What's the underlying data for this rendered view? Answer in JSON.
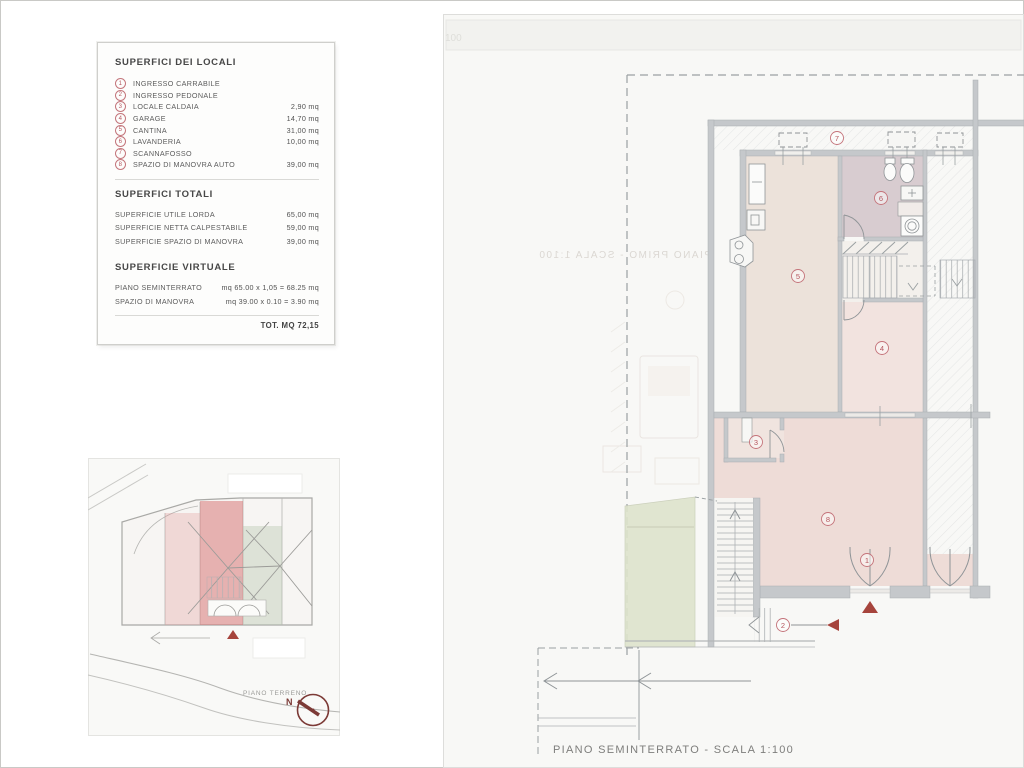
{
  "legend": {
    "title": "SUPERFICI DEI LOCALI",
    "items": [
      {
        "num": "1",
        "label": "INGRESSO CARRABILE",
        "value": ""
      },
      {
        "num": "2",
        "label": "INGRESSO PEDONALE",
        "value": ""
      },
      {
        "num": "3",
        "label": "LOCALE CALDAIA",
        "value": "2,90 mq"
      },
      {
        "num": "4",
        "label": "GARAGE",
        "value": "14,70 mq"
      },
      {
        "num": "5",
        "label": "CANTINA",
        "value": "31,00 mq"
      },
      {
        "num": "6",
        "label": "LAVANDERIA",
        "value": "10,00 mq"
      },
      {
        "num": "7",
        "label": "SCANNAFOSSO",
        "value": ""
      },
      {
        "num": "8",
        "label": "SPAZIO DI MANOVRA AUTO",
        "value": "39,00 mq"
      }
    ],
    "totals": {
      "title": "SUPERFICI TOTALI",
      "rows": [
        {
          "label": "SUPERFICIE UTILE LORDA",
          "value": "65,00 mq"
        },
        {
          "label": "SUPERFICIE NETTA CALPESTABILE",
          "value": "59,00 mq"
        },
        {
          "label": "SUPERFICIE SPAZIO DI MANOVRA",
          "value": "39,00 mq"
        }
      ]
    },
    "virtual": {
      "title": "SUPERFICIE VIRTUALE",
      "rows": [
        {
          "label": "PIANO SEMINTERRATO",
          "value": "mq 65.00 x 1,05 = 68.25 mq"
        },
        {
          "label": "SPAZIO DI MANOVRA",
          "value": "mq 39.00 x 0.10 = 3.90 mq"
        }
      ],
      "total": "TOT. MQ 72,15"
    }
  },
  "site_plan": {
    "caption": "PIANO TERRENO",
    "north_label": "N"
  },
  "floor_plan": {
    "caption": "PIANO SEMINTERRATO - SCALA 1:100",
    "bleed_caption": "PIANO PRIMO - SCALA 1:100",
    "corner_mark": "100",
    "room_numbers": [
      "1",
      "2",
      "3",
      "4",
      "5",
      "6",
      "7",
      "8"
    ]
  },
  "colors": {
    "badge_red": "#b5565e",
    "marker_red": "#a6443c",
    "overlay_pink_strong": "#d66e6e",
    "overlay_pink_light": "#e19696",
    "garden_green": "#dee3cc",
    "room_pink": "#eedcd7",
    "room_mauve": "#d8ccd0",
    "room_beige": "#ece2da",
    "wall_gray": "#c5c8cb",
    "compass_red": "#7c3a36"
  }
}
